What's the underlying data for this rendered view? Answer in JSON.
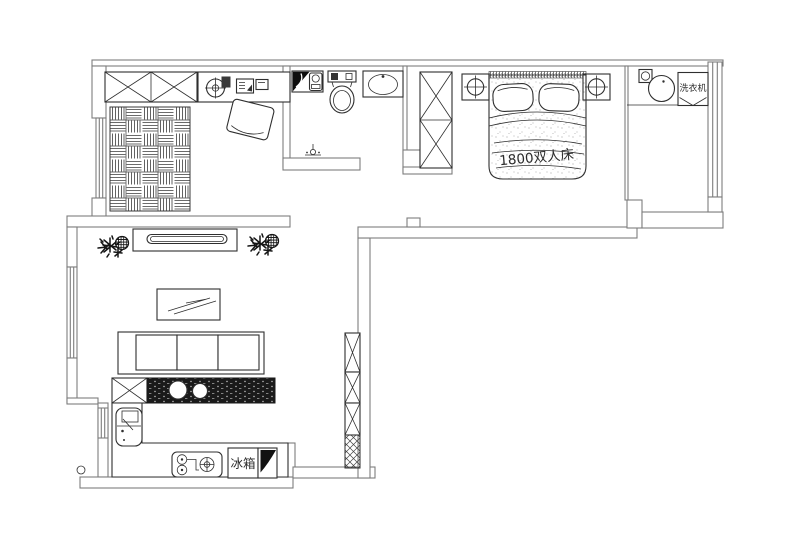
{
  "document": {
    "type": "apartment-floor-plan",
    "style": "CAD line drawing"
  },
  "labels": {
    "bed": "1800双人床",
    "washing_machine": "洗衣机",
    "refrigerator": "冰箱"
  },
  "colors": {
    "background": "#ffffff",
    "wall_line": "#7d7d7d",
    "furniture_line": "#2f2f2f",
    "dark_fill": "#141414"
  },
  "symbols": [
    "closet",
    "desk",
    "office-swivel-chair",
    "desk-chair",
    "computer",
    "tatami-mat",
    "shower-heater",
    "toilet",
    "wash-basin",
    "floor-drain",
    "wardrobe",
    "double-bed",
    "pillow",
    "nightstand-lamp",
    "laundry-basin",
    "washing-machine",
    "plant",
    "tv-cabinet",
    "tv",
    "coffee-table",
    "sofa",
    "bar-counter",
    "bar-sink",
    "kitchen-counter",
    "kitchen-sink",
    "gas-stove",
    "refrigerator",
    "corner-cabinet",
    "tall-cabinet",
    "window"
  ]
}
